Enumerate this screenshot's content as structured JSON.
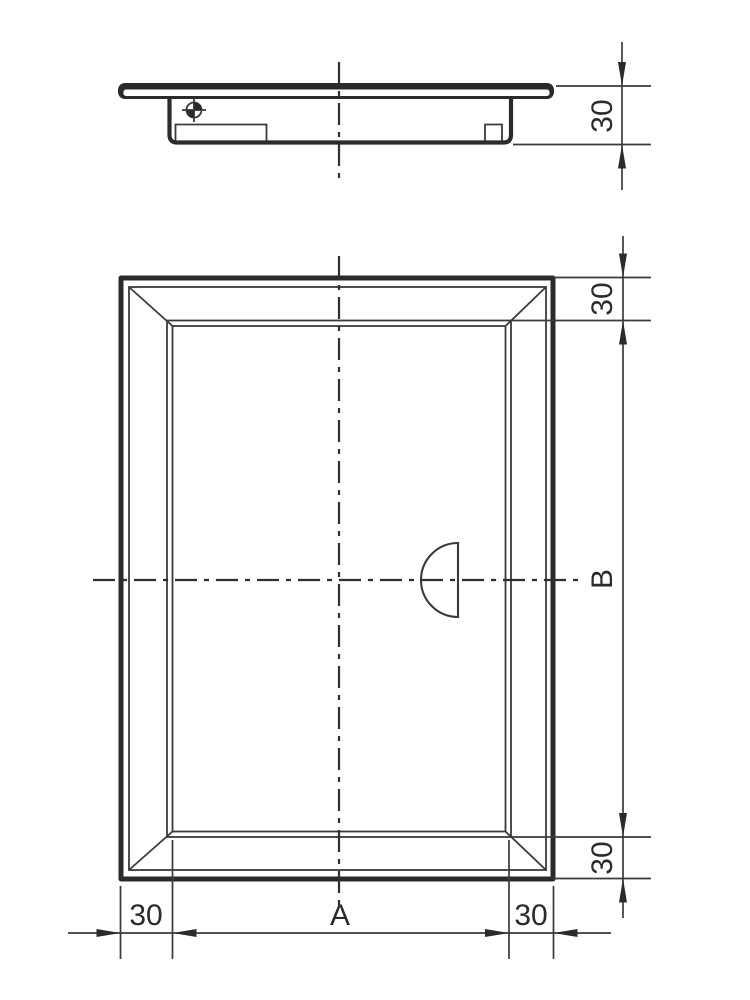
{
  "drawing": {
    "type": "technical-drawing-access-panel",
    "background": "#ffffff",
    "line_color": "#2b2b2b",
    "views": {
      "side_section": {
        "dims": {
          "thickness": "30"
        },
        "symbols": {
          "position_target": "target-crosshair-icon"
        }
      },
      "front": {
        "dims": {
          "frame_top": "30",
          "height": "B",
          "frame_bottom": "30",
          "frame_left": "30",
          "width": "A",
          "frame_right": "30"
        },
        "symbols": {
          "handle": "half-circle-grip-icon"
        }
      }
    }
  }
}
